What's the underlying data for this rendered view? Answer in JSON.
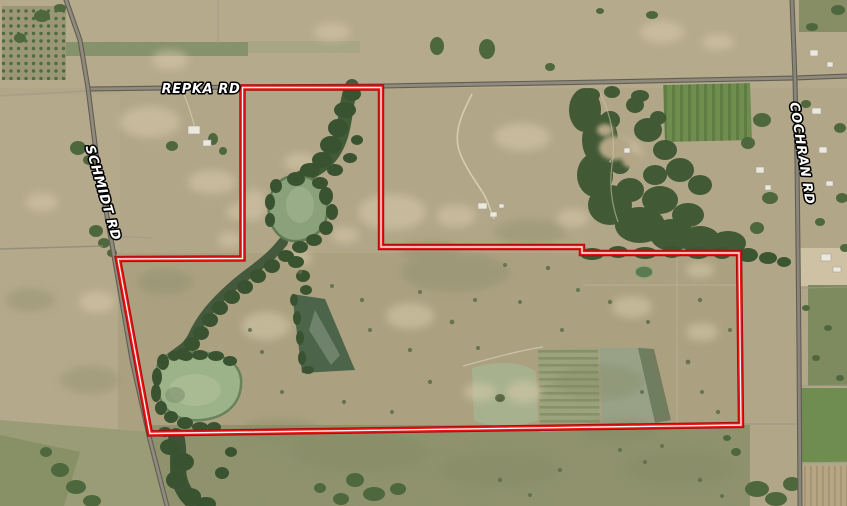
{
  "map": {
    "kind": "satellite-map-with-parcel-boundary",
    "road_labels": [
      {
        "name": "repka-rd",
        "label": "REPKA RD"
      },
      {
        "name": "schmidt-rd",
        "label": "SCHMIDT RD"
      },
      {
        "name": "cochran-rd",
        "label": "COCHRAN RD"
      }
    ],
    "label_style": {
      "fill": "#ffffff",
      "outline": "#000000"
    },
    "boundary": {
      "outline_color": "#a50c0c",
      "stroke_color": "#e81313",
      "centerline_color": "#ffffff",
      "points": "242.5,87.5 381,87.5 381,247 582,247 582,253 739,253 741,425 150,433.5 118,259 242.5,258.5"
    }
  }
}
